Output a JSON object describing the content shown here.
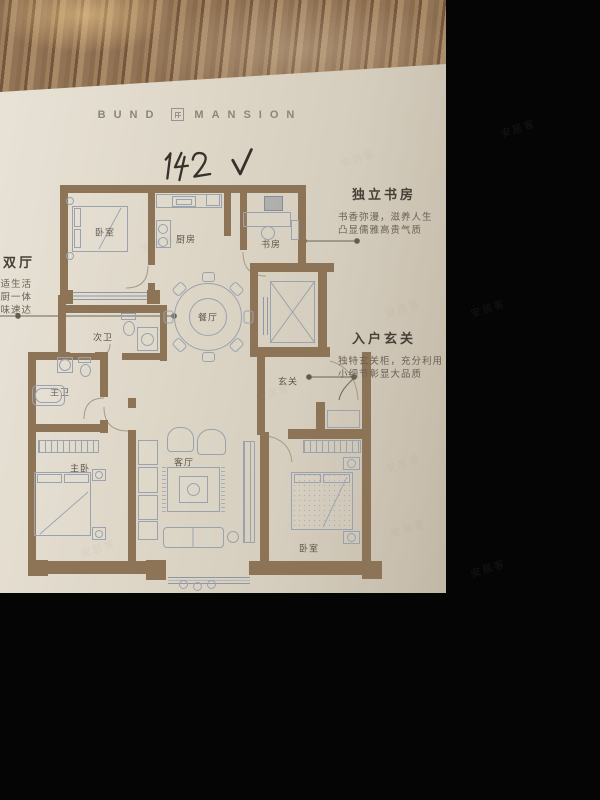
{
  "brand": {
    "word1": "BUND",
    "word2": "MANSION",
    "logo": "square-emblem-icon"
  },
  "handwriting": {
    "number": "142",
    "mark": "check"
  },
  "floorplan": {
    "rooms": [
      {
        "label": "卧室"
      },
      {
        "label": "厨房"
      },
      {
        "label": "书房"
      },
      {
        "label": "餐厅"
      },
      {
        "label": "次卫"
      },
      {
        "label": "主卫"
      },
      {
        "label": "主卧"
      },
      {
        "label": "客厅"
      },
      {
        "label": "卧室"
      },
      {
        "label": "玄关"
      }
    ],
    "annotations": {
      "left": {
        "heading": "大双厅",
        "lines": [
          "舒适生活",
          "餐厨一体",
          "美味速达"
        ]
      },
      "study": {
        "heading": "独立书房",
        "lines": [
          "书香弥漫，滋养人生",
          "凸显儒雅高贵气质"
        ]
      },
      "entry": {
        "heading": "入户玄关",
        "lines": [
          "独特玄关柜，充分利用",
          "小细节彰显大品质"
        ]
      }
    }
  },
  "watermark_text": "安居客",
  "colors": {
    "wall": "#8d7457",
    "paper": "#ddd5c6",
    "wood": "#96775a",
    "furniture_line": "#9aa2ad",
    "label_text": "#5c564c",
    "background": "#050505"
  }
}
